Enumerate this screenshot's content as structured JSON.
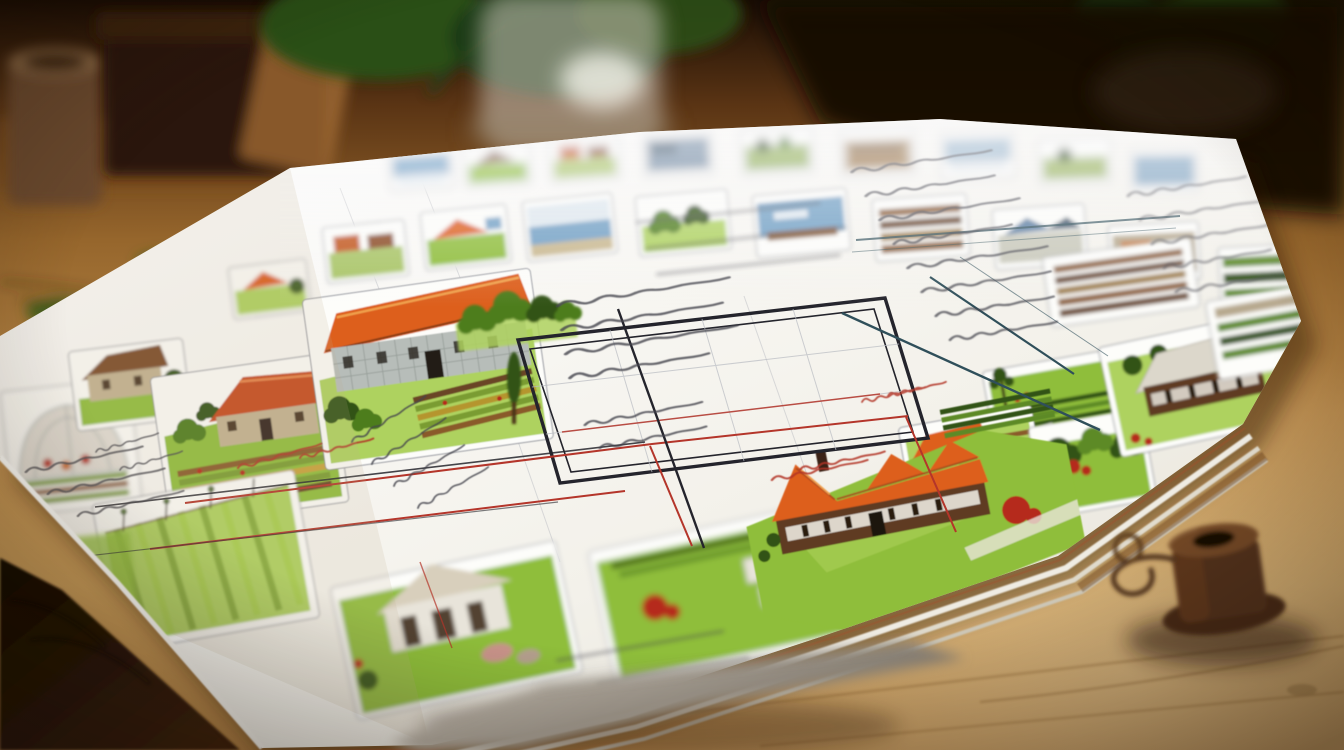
{
  "scene": {
    "type": "photograph",
    "description": "Hand-illustrated homestead and garden planning sheet lying on a rustic wooden table; blurred potted plants and a glass jar behind, a spool of twine and scissors blade in front; the sheet holds small farm vignettes, ruled tables in red and dark ink, and illegible handwritten notes",
    "handwriting_legible": false,
    "visible_text": ""
  },
  "palette": {
    "wood_light": "#cfa05f",
    "wood_mid": "#9a6a33",
    "wood_dark": "#4a2a0e",
    "wood_black": "#1c0f04",
    "paper_white": "#f8f7f2",
    "paper_shade": "#e6e2d7",
    "ink_dark": "#45454e",
    "ink_red": "#b23527",
    "grid_red": "#b4352a",
    "grid_dark": "#24242c",
    "rule_teal": "#2f4f5a",
    "lawn_green": "#8fbe3a",
    "lawn_light": "#aed25e",
    "tree_green": "#4e7d1f",
    "tree_dark": "#335214",
    "hedge_green": "#5d8a28",
    "roof_orange": "#dd5f1e",
    "roof_red": "#c64a1e",
    "roof_brown": "#7a4a28",
    "roof_white": "#dcd7cb",
    "wall_brown": "#5f3b22",
    "wall_stone": "#c3b291",
    "wall_stone_blue": "#b7bdb9",
    "wall_white": "#e8e4da",
    "water_blue": "#6f9fc4",
    "flower_red": "#b52a1e",
    "soil_brown": "#8a5a2b",
    "soil_dark": "#6b4526",
    "glass_gray": "#cdc7bb",
    "leaf_green": "#2c4f17",
    "pot_dark": "#261408",
    "moss_green": "#46611e",
    "spool_brown": "#53301a",
    "twine_brown": "#5a3a1e",
    "blade_gray": "#a39a8e"
  },
  "paper": {
    "sheets_in_stack": 3,
    "thumbnails_top_row": 9,
    "thumbnails_second_row": 10,
    "vignettes": [
      "greenhouse-dome",
      "brown-roof-cottage",
      "red-roof-farmhouse-with-kitchen-garden",
      "stone-barn-with-orange-roof",
      "tree-cluster",
      "cypress-tree",
      "plowed-field-rows",
      "flap-farm-sketches",
      "cream-farmhouse-with-livestock",
      "lawn-with-red-bush-and-sheds",
      "long-orange-roof-farmhouse",
      "hedge-garden-with-pole-tree",
      "green-walled-house-with-garden-rows",
      "bush-cluster-with-red-flowers",
      "pale-roof-house-on-lawn",
      "tilled-rows-thumbnail",
      "hedge-thumbnail"
    ],
    "rule_colors": {
      "red": "#b4352a",
      "dark": "#24242c",
      "teal": "#2f4f5a",
      "light_gray": "#b9bcc2"
    },
    "ink_colors": {
      "notes": "#45454e",
      "annotations_red": "#b23527"
    }
  },
  "foreground": {
    "objects": [
      "twine-spool",
      "twine-loop",
      "scissors-blade",
      "paper-stack-edges"
    ]
  },
  "background": {
    "objects": [
      "wooden-table",
      "plant-pot",
      "planter-box",
      "plant-leaves",
      "glass-jar",
      "moss-clumps",
      "dark-room-background"
    ]
  }
}
